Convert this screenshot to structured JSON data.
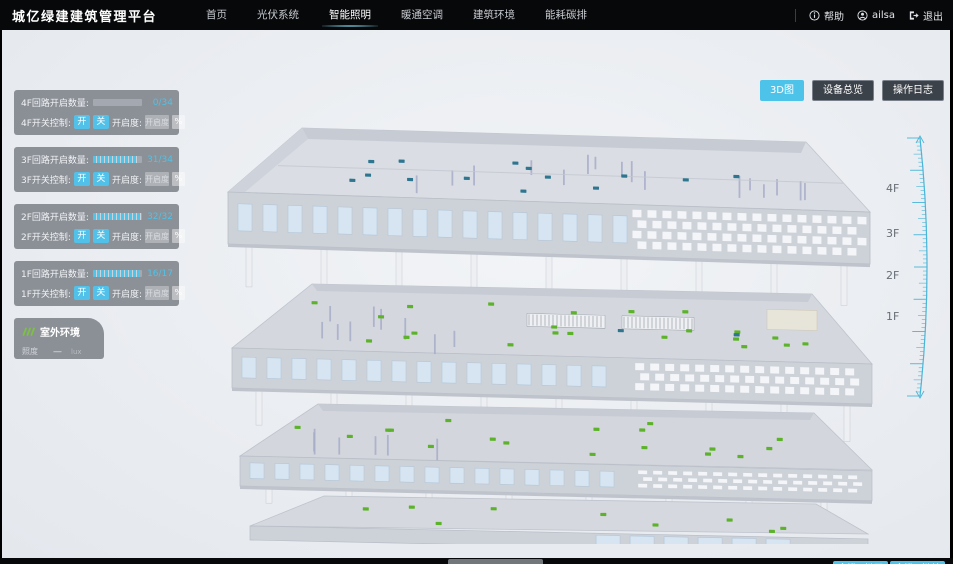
{
  "header": {
    "title": "城亿绿建建筑管理平台",
    "nav": [
      {
        "label": "首页",
        "active": false
      },
      {
        "label": "光伏系统",
        "active": false
      },
      {
        "label": "智能照明",
        "active": true
      },
      {
        "label": "暖通空调",
        "active": false
      },
      {
        "label": "建筑环境",
        "active": false
      },
      {
        "label": "能耗碳排",
        "active": false
      }
    ],
    "help_label": "帮助",
    "user_name": "ailsa",
    "logout_label": "退出"
  },
  "view_buttons": [
    {
      "label": "3D图",
      "active": true
    },
    {
      "label": "设备总览",
      "active": false
    },
    {
      "label": "操作日志",
      "active": false
    }
  ],
  "floor_panels": [
    {
      "floor": "4F",
      "count_label": "4F回路开启数量:",
      "on": 0,
      "total": 34,
      "count_text": "0/34",
      "switch_label": "4F开关控制:",
      "on_btn": "开",
      "off_btn": "关",
      "dim_label": "开启度:",
      "dim_placeholder": "开启度",
      "percent_label": "%"
    },
    {
      "floor": "3F",
      "count_label": "3F回路开启数量:",
      "on": 31,
      "total": 34,
      "count_text": "31/34",
      "switch_label": "3F开关控制:",
      "on_btn": "开",
      "off_btn": "关",
      "dim_label": "开启度:",
      "dim_placeholder": "开启度",
      "percent_label": "%"
    },
    {
      "floor": "2F",
      "count_label": "2F回路开启数量:",
      "on": 32,
      "total": 32,
      "count_text": "32/32",
      "switch_label": "2F开关控制:",
      "on_btn": "开",
      "off_btn": "关",
      "dim_label": "开启度:",
      "dim_placeholder": "开启度",
      "percent_label": "%"
    },
    {
      "floor": "1F",
      "count_label": "1F回路开启数量:",
      "on": 16,
      "total": 17,
      "count_text": "16/17",
      "switch_label": "1F开关控制:",
      "on_btn": "开",
      "off_btn": "关",
      "dim_label": "开启度:",
      "dim_placeholder": "开启度",
      "percent_label": "%"
    }
  ],
  "outdoor": {
    "title": "室外环境",
    "metric_label": "照度",
    "metric_value": "—",
    "metric_unit": "lux"
  },
  "floor_axis": [
    "4F",
    "3F",
    "2F",
    "1F"
  ],
  "legend": {
    "on_label": "开启",
    "off_label": "关闭",
    "on_color": "#97c55e",
    "off_color": "#7aa7d8"
  },
  "bottom_buttons": [
    {
      "label": "全楼一键开"
    },
    {
      "label": "全楼一键关"
    }
  ],
  "colors": {
    "accent": "#4ec3ea",
    "accent2": "#49b6d8",
    "on_dot": "#5cb229",
    "off_dot": "#2e768f"
  },
  "building": {
    "floors": [
      {
        "label": "4F",
        "on_dots": 0,
        "off_dots": 14
      },
      {
        "label": "3F",
        "on_dots": 22,
        "off_dots": 2
      },
      {
        "label": "2F",
        "on_dots": 18,
        "off_dots": 0
      },
      {
        "label": "1F",
        "on_dots": 9,
        "off_dots": 0
      }
    ]
  }
}
